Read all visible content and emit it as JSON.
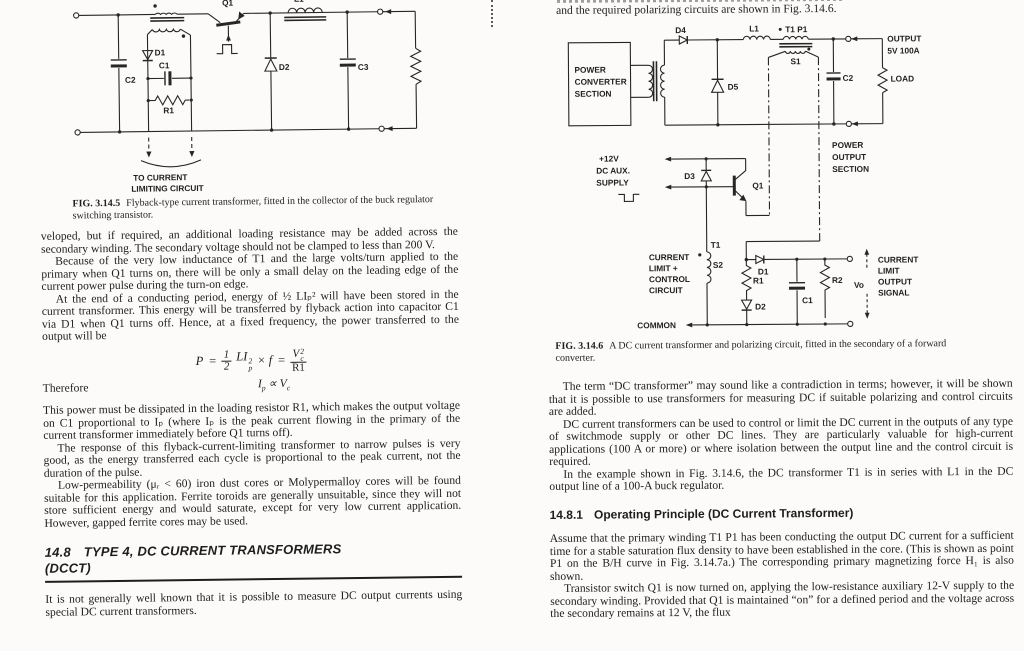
{
  "left": {
    "fig1": {
      "caption_label": "FIG. 3.14.5",
      "caption": "Flyback-type current transformer, fitted in the collector of the buck regulator switching transistor.",
      "labels": {
        "q1": "Q1",
        "l1": "L1",
        "d1": "D1",
        "c1": "C1",
        "r1": "R1",
        "c2": "C2",
        "d2": "D2",
        "c3": "C3",
        "note1": "TO CURRENT",
        "note2": "LIMITING CIRCUIT"
      }
    },
    "paragraphs": [
      "veloped, but if required, an additional loading resistance may be added across the secondary winding. The secondary voltage should not be clamped to less than 200 V.",
      "Because of the very low inductance of T1 and the large volts/turn applied to the primary when Q1 turns on, there will be only a small delay on the leading edge of the current power pulse during the turn-on edge.",
      "At the end of a conducting period, energy of ½ LIₚ² will have been stored in the current transformer. This energy will be transferred by flyback action into capacitor C1 via D1 when Q1 turns off. Hence, at a fixed frequency, the power transferred to the output will be",
      "This power must be dissipated in the loading resistor R1, which makes the output voltage on C1 proportional to Iₚ (where Iₚ is the peak current flowing in the primary of the current transformer immediately before Q1 turns off).",
      "The response of this flyback-current-limiting transformer to narrow pulses is very good, as the energy transferred each cycle is proportional to the peak current, not the duration of the pulse.",
      "Low-permeability (μᵣ < 60) iron dust cores or Molypermalloy cores will be found suitable for this application. Ferrite toroids are generally unsuitable, since they will not store sufficient energy and would saturate, except for very low current application. However, gapped ferrite cores may be used.",
      "It is not generally well known that it is possible to measure DC output currents using special DC current transformers."
    ],
    "equation": {
      "P": "P",
      "eq1": "=",
      "one": "1",
      "two": "2",
      "LI": "LI",
      "sup": "2",
      "sub": "p",
      "mul": "× f",
      "eq2": "=",
      "V": "V",
      "vsup": "2",
      "vsub": "c",
      "den": "R1"
    },
    "therefore": "Therefore",
    "proportion": {
      "I": "I",
      "isub": "p",
      "rel": "∝",
      "V": "V",
      "vsub": "c"
    },
    "section": {
      "number": "14.8",
      "title": "TYPE 4, DC CURRENT TRANSFORMERS",
      "subtitle": "(DCCT)"
    }
  },
  "right": {
    "intro": "and the required polarizing circuits are shown in Fig. 3.14.6.",
    "fig2": {
      "caption_label": "FIG. 3.14.6",
      "caption": "A DC current transformer and polarizing circuit, fitted in the secondary of a forward converter.",
      "labels": {
        "pcs1": "POWER",
        "pcs2": "CONVERTER",
        "pcs3": "SECTION",
        "d4": "D4",
        "l1": "L1",
        "t1p1": "T1 P1",
        "s1": "S1",
        "d5": "D5",
        "c2": "C2",
        "out1": "OUTPUT",
        "out2": "5V 100A",
        "load": "LOAD",
        "pos1": "POWER",
        "pos2": "OUTPUT",
        "pos3": "SECTION",
        "aux1": "+12V",
        "aux2": "DC AUX.",
        "aux3": "SUPPLY",
        "d3": "D3",
        "q1": "Q1",
        "clc1": "CURRENT",
        "clc2": "LIMIT +",
        "clc3": "CONTROL",
        "clc4": "CIRCUIT",
        "t1": "T1",
        "s2": "S2",
        "d1": "D1",
        "r1": "R1",
        "d2": "D2",
        "c1": "C1",
        "r2": "R2",
        "vo": "Vo",
        "clos1": "CURRENT",
        "clos2": "LIMIT",
        "clos3": "OUTPUT",
        "clos4": "SIGNAL",
        "common": "COMMON"
      }
    },
    "paragraphs": [
      "The term “DC transformer” may sound like a contradiction in terms; however, it will be shown that it is possible to use transformers for measuring DC if suitable polarizing and control circuits are added.",
      "DC current transformers can be used to control or limit the DC current in the outputs of any type of switchmode supply or other DC lines. They are particularly valuable for high-current applications (100 A or more) or where isolation between the output line and the control circuit is required.",
      "In the example shown in Fig. 3.14.6, the DC transformer T1 is in series with L1 in the DC output line of a 100-A buck regulator.",
      "Assume that the primary winding T1 P1 has been conducting the output DC current for a sufficient time for a stable saturation flux density to have been established in the core. (This is shown as point P1 on the B/H curve in Fig. 3.14.7a.) The corresponding primary magnetizing force H₁ is also shown.",
      "Transistor switch Q1 is now turned on, applying the low-resistance auxiliary 12-V supply to the secondary winding. Provided that Q1 is maintained “on” for a defined period and the voltage across the secondary remains at 12 V, the flux"
    ],
    "section": {
      "number": "14.8.1",
      "title": "Operating Principle (DC Current Transformer)"
    }
  }
}
